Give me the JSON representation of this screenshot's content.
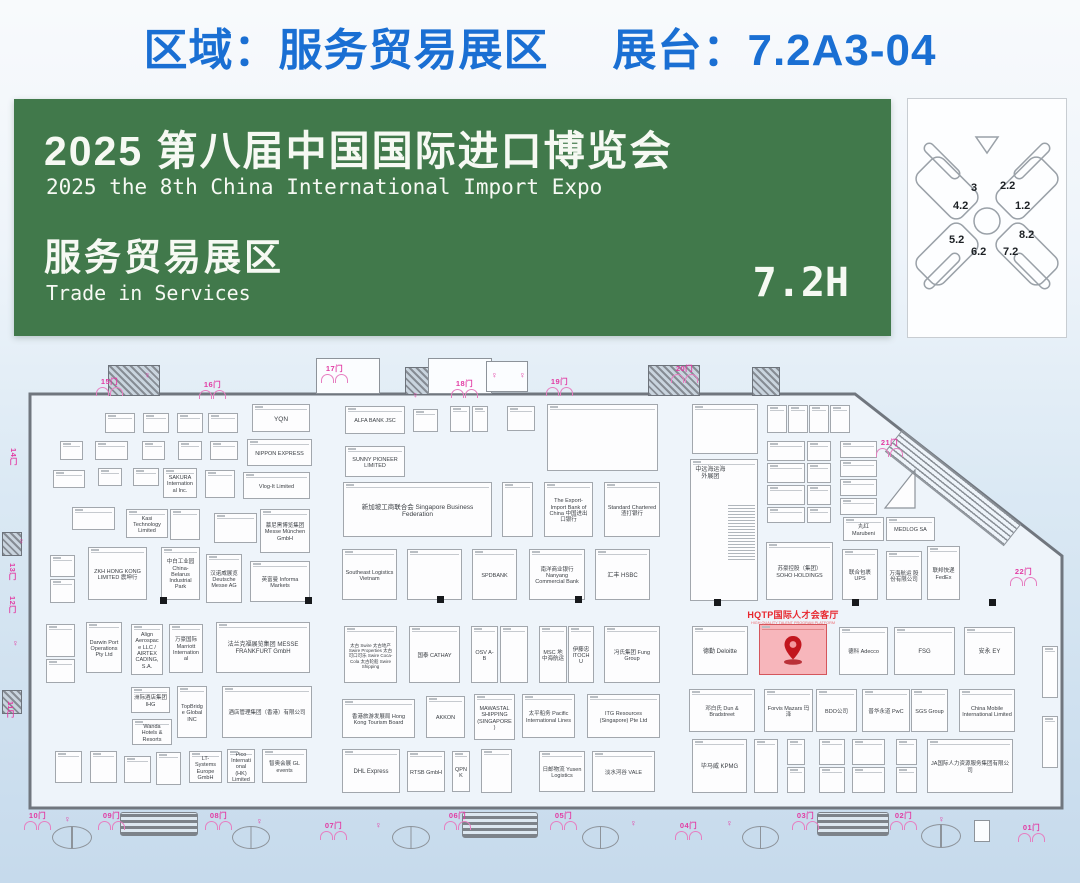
{
  "colors": {
    "accent": "#1a6fd3",
    "banner_bg": "#41794b",
    "magenta": "#e23ba3",
    "highlight_fill": "#f7b6bb",
    "pin_red": "#c2161e"
  },
  "header": {
    "zone_label": "区域：服务贸易展区",
    "booth_label": "展台：7.2A3-04"
  },
  "banner": {
    "zh_title": "2025 第八届中国国际进口博览会",
    "en_title": "2025 the 8th China International Import Expo",
    "zh_zone": "服务贸易展区",
    "en_zone": "Trade in Services",
    "hall_code": "7.2H"
  },
  "minimap": {
    "halls": [
      {
        "label": "3",
        "x": 63,
        "y": 83
      },
      {
        "label": "2.2",
        "x": 92,
        "y": 81
      },
      {
        "label": "4.2",
        "x": 45,
        "y": 101
      },
      {
        "label": "1.2",
        "x": 107,
        "y": 101
      },
      {
        "label": "5.2",
        "x": 41,
        "y": 135
      },
      {
        "label": "8.2",
        "x": 111,
        "y": 130
      },
      {
        "label": "6.2",
        "x": 63,
        "y": 147
      },
      {
        "label": "7.2",
        "x": 95,
        "y": 147
      }
    ]
  },
  "target": {
    "name": "HQTP国际人才会客厅",
    "subtitle": "HIGH QUALITY TALENT PROGRAM PLATFORM",
    "booth_no": "7.2A3-04"
  },
  "plan": {
    "gates": [
      [
        "15门",
        96,
        376,
        "h"
      ],
      [
        "16门",
        199,
        379,
        "h"
      ],
      [
        "17门",
        321,
        363,
        "h"
      ],
      [
        "18门",
        451,
        378,
        "h"
      ],
      [
        "19门",
        546,
        376,
        "h"
      ],
      [
        "20门",
        671,
        363,
        "h"
      ],
      [
        "21门",
        876,
        437,
        "h"
      ],
      [
        "22门",
        1010,
        566,
        "h"
      ],
      [
        "14门",
        8,
        448,
        "v"
      ],
      [
        "13门",
        7,
        563,
        "v"
      ],
      [
        "12门",
        7,
        596,
        "v"
      ],
      [
        "11门",
        5,
        701,
        "v"
      ],
      [
        "10门",
        24,
        810,
        "h"
      ],
      [
        "09门",
        98,
        810,
        "h"
      ],
      [
        "08门",
        205,
        810,
        "h"
      ],
      [
        "07门",
        320,
        820,
        "h"
      ],
      [
        "06门",
        444,
        810,
        "h"
      ],
      [
        "05门",
        550,
        810,
        "h"
      ],
      [
        "04门",
        675,
        820,
        "h"
      ],
      [
        "03门",
        792,
        810,
        "h"
      ],
      [
        "02门",
        890,
        810,
        "h"
      ],
      [
        "01门",
        1018,
        822,
        "h"
      ]
    ],
    "booths": [
      [
        105,
        413,
        30,
        20,
        ""
      ],
      [
        143,
        413,
        26,
        20,
        ""
      ],
      [
        177,
        413,
        26,
        20,
        ""
      ],
      [
        208,
        413,
        30,
        20,
        ""
      ],
      [
        60,
        441,
        23,
        19,
        ""
      ],
      [
        95,
        441,
        33,
        19,
        ""
      ],
      [
        142,
        441,
        23,
        19,
        ""
      ],
      [
        178,
        441,
        24,
        19,
        ""
      ],
      [
        210,
        441,
        28,
        19,
        ""
      ],
      [
        252,
        404,
        58,
        28,
        "YQN",
        6.5
      ],
      [
        247,
        439,
        65,
        27,
        "NIPPON EXPRESS",
        5.5
      ],
      [
        345,
        406,
        60,
        28,
        "ALFA BANK JSC"
      ],
      [
        345,
        446,
        60,
        31,
        "SUNNY PIONEER LIMITED"
      ],
      [
        413,
        409,
        25,
        23,
        ""
      ],
      [
        450,
        406,
        20,
        26,
        ""
      ],
      [
        472,
        406,
        16,
        26,
        ""
      ],
      [
        507,
        406,
        28,
        25,
        ""
      ],
      [
        547,
        404,
        111,
        67,
        ""
      ],
      [
        692,
        404,
        66,
        50,
        ""
      ],
      [
        767,
        405,
        20,
        28,
        ""
      ],
      [
        788,
        405,
        20,
        28,
        ""
      ],
      [
        809,
        405,
        20,
        28,
        ""
      ],
      [
        830,
        405,
        20,
        28,
        ""
      ],
      [
        767,
        441,
        38,
        20,
        ""
      ],
      [
        807,
        441,
        24,
        20,
        ""
      ],
      [
        767,
        463,
        38,
        20,
        ""
      ],
      [
        807,
        463,
        24,
        20,
        ""
      ],
      [
        767,
        485,
        38,
        20,
        ""
      ],
      [
        807,
        485,
        24,
        20,
        ""
      ],
      [
        767,
        507,
        38,
        16,
        ""
      ],
      [
        807,
        507,
        24,
        16,
        ""
      ],
      [
        840,
        441,
        37,
        17,
        ""
      ],
      [
        840,
        460,
        37,
        17,
        ""
      ],
      [
        840,
        479,
        37,
        17,
        ""
      ],
      [
        840,
        498,
        37,
        17,
        ""
      ],
      [
        53,
        470,
        32,
        18,
        ""
      ],
      [
        98,
        468,
        24,
        18,
        ""
      ],
      [
        133,
        468,
        26,
        18,
        ""
      ],
      [
        163,
        468,
        34,
        30,
        "SAKURA International Inc."
      ],
      [
        205,
        470,
        30,
        28,
        ""
      ],
      [
        243,
        472,
        67,
        27,
        "Vlog-It Limited"
      ],
      [
        72,
        507,
        43,
        23,
        ""
      ],
      [
        126,
        509,
        42,
        29,
        "Kasi Technology Limited"
      ],
      [
        170,
        509,
        30,
        31,
        ""
      ],
      [
        214,
        513,
        43,
        30,
        ""
      ],
      [
        260,
        509,
        50,
        44,
        "慕尼黑博览集团 Messe München GmbH"
      ],
      [
        343,
        482,
        149,
        55,
        "新加坡工商联合会 Singapore Business Federation",
        6.5
      ],
      [
        502,
        482,
        31,
        55,
        ""
      ],
      [
        544,
        482,
        49,
        55,
        "The Export-Import Bank of China 中国进出口银行"
      ],
      [
        604,
        482,
        56,
        55,
        "Standard Chartered 渣打银行"
      ],
      [
        690,
        459,
        68,
        142,
        "中远海运海外展团",
        6,
        "dense"
      ],
      [
        843,
        517,
        41,
        24,
        "丸红 Marubeni"
      ],
      [
        886,
        517,
        49,
        24,
        "MEDLOG SA"
      ],
      [
        50,
        555,
        25,
        22,
        ""
      ],
      [
        50,
        579,
        25,
        24,
        ""
      ],
      [
        88,
        547,
        59,
        53,
        "ZKH HONG KONG LIMITED 震坤行"
      ],
      [
        161,
        547,
        39,
        53,
        "中白工业园 China-Belarus Industrial Park"
      ],
      [
        206,
        554,
        36,
        49,
        "汉诺威展览 Deutsche Messe AG"
      ],
      [
        250,
        561,
        60,
        41,
        "英富曼 Informa Markets"
      ],
      [
        342,
        549,
        55,
        51,
        "Southeast Logistics Vietnam"
      ],
      [
        407,
        549,
        55,
        51,
        ""
      ],
      [
        472,
        549,
        45,
        51,
        "SPDBANK"
      ],
      [
        529,
        549,
        56,
        51,
        "南洋商业银行 Nanyang Commercial Bank"
      ],
      [
        595,
        549,
        55,
        51,
        "汇丰 HSBC",
        6
      ],
      [
        766,
        542,
        67,
        58,
        "苏豪控股（集团） SOHO HOLDINGS"
      ],
      [
        842,
        549,
        36,
        51,
        "联合包裹 UPS"
      ],
      [
        886,
        551,
        36,
        49,
        "万海航运 股份有限公司"
      ],
      [
        927,
        546,
        33,
        54,
        "联邦快递 FedEx"
      ],
      [
        46,
        624,
        29,
        33,
        ""
      ],
      [
        46,
        659,
        29,
        24,
        ""
      ],
      [
        86,
        622,
        36,
        51,
        "Darwin Port Operations Pty Ltd"
      ],
      [
        131,
        624,
        32,
        51,
        "Align Aerospace LLC / AIRTEX CADING,S.A."
      ],
      [
        169,
        624,
        34,
        49,
        "万豪国际 Marriott International"
      ],
      [
        216,
        622,
        94,
        51,
        "法兰克福展览集团 MESSE FRANKFURT GmbH",
        6
      ],
      [
        344,
        626,
        53,
        57,
        "太古 Swire 太古地产 Swire Properties 太古可口可乐 Swire Coca-Cola 太古轮船 Swire Shipping",
        4.5
      ],
      [
        409,
        626,
        51,
        57,
        "国泰 CATHAY"
      ],
      [
        471,
        626,
        27,
        57,
        "OSV A-B"
      ],
      [
        500,
        626,
        28,
        57,
        ""
      ],
      [
        539,
        626,
        28,
        57,
        "MSC 地中海航运"
      ],
      [
        568,
        626,
        26,
        57,
        "伊藤忠 ITOCHU"
      ],
      [
        604,
        626,
        56,
        57,
        "冯氏集团 Fung Group"
      ],
      [
        692,
        626,
        56,
        49,
        "德勤 Deloitte",
        6
      ],
      [
        759,
        624,
        68,
        51,
        "",
        5.5,
        "hl"
      ],
      [
        839,
        627,
        49,
        48,
        "德科 Adecco"
      ],
      [
        894,
        627,
        61,
        48,
        "FSG",
        6
      ],
      [
        964,
        627,
        51,
        48,
        "安永 EY",
        6
      ],
      [
        131,
        687,
        39,
        26,
        "洲际酒店集团 IHG"
      ],
      [
        177,
        686,
        30,
        52,
        "TopBridge Global INC"
      ],
      [
        132,
        719,
        40,
        26,
        "Wanda Hotels & Resorts"
      ],
      [
        222,
        686,
        90,
        52,
        "酒店管理集团（香港）有限公司"
      ],
      [
        342,
        699,
        73,
        39,
        "香港旅游发展局 Hong Kong Tourism Board"
      ],
      [
        426,
        696,
        39,
        42,
        "AKKON"
      ],
      [
        474,
        694,
        41,
        46,
        "MAWASTAL SHIPPING (SINGAPORE)"
      ],
      [
        522,
        694,
        53,
        44,
        "太平船务 Pacific International Lines"
      ],
      [
        587,
        694,
        73,
        44,
        "ITG Resources (Singapore) Pte Ltd"
      ],
      [
        689,
        689,
        66,
        43,
        "邓白氏 Dun & Bradstreet"
      ],
      [
        764,
        689,
        49,
        43,
        "Forvis Mazars 玛泽"
      ],
      [
        816,
        689,
        41,
        43,
        "BDO公司"
      ],
      [
        862,
        689,
        48,
        43,
        "普华永道 PwC"
      ],
      [
        911,
        689,
        37,
        43,
        "SGS Group"
      ],
      [
        959,
        689,
        56,
        43,
        "China Mobile International Limited"
      ],
      [
        55,
        751,
        27,
        32,
        ""
      ],
      [
        90,
        751,
        27,
        32,
        ""
      ],
      [
        124,
        756,
        27,
        27,
        ""
      ],
      [
        156,
        752,
        25,
        33,
        ""
      ],
      [
        189,
        751,
        33,
        32,
        "LT-Systems Europe GmbH"
      ],
      [
        227,
        749,
        28,
        34,
        "Pico International (HK) Limited"
      ],
      [
        262,
        749,
        45,
        34,
        "智奥会展 GL events"
      ],
      [
        342,
        749,
        58,
        44,
        "DHL Express",
        6
      ],
      [
        407,
        751,
        38,
        41,
        "RTSB GmbH"
      ],
      [
        452,
        751,
        18,
        41,
        "QPNK"
      ],
      [
        481,
        749,
        31,
        44,
        ""
      ],
      [
        539,
        751,
        46,
        41,
        "日邮物流 Yusen Logistics"
      ],
      [
        592,
        751,
        63,
        41,
        "淡水河谷 VALE"
      ],
      [
        692,
        739,
        55,
        54,
        "毕马威 KPMG",
        6
      ],
      [
        754,
        739,
        24,
        54,
        ""
      ],
      [
        787,
        739,
        18,
        26,
        ""
      ],
      [
        787,
        767,
        18,
        26,
        ""
      ],
      [
        819,
        739,
        26,
        26,
        ""
      ],
      [
        819,
        767,
        26,
        26,
        ""
      ],
      [
        852,
        739,
        33,
        26,
        ""
      ],
      [
        852,
        767,
        33,
        26,
        ""
      ],
      [
        896,
        739,
        21,
        26,
        ""
      ],
      [
        896,
        767,
        21,
        26,
        ""
      ],
      [
        927,
        739,
        86,
        54,
        "JA国际人力资源服务集团有限公司"
      ],
      [
        1042,
        646,
        16,
        52,
        "",
        4
      ],
      [
        1042,
        716,
        16,
        52,
        "",
        4
      ]
    ],
    "columns": [
      [
        160,
        597
      ],
      [
        305,
        597
      ],
      [
        437,
        596
      ],
      [
        575,
        596
      ],
      [
        714,
        599
      ],
      [
        852,
        599
      ],
      [
        989,
        599
      ]
    ],
    "facilities": {
      "stairs": [
        [
          120,
          812,
          76,
          22
        ],
        [
          462,
          812,
          74,
          24
        ],
        [
          817,
          812,
          70,
          22
        ]
      ],
      "wc": [
        [
          52,
          826,
          38,
          21
        ],
        [
          232,
          826,
          36,
          21
        ],
        [
          392,
          826,
          36,
          21
        ],
        [
          582,
          826,
          35,
          21
        ],
        [
          742,
          826,
          35,
          21
        ],
        [
          921,
          824,
          38,
          22
        ]
      ],
      "blocks": [
        [
          108,
          365,
          50,
          29
        ],
        [
          648,
          365,
          50,
          29
        ],
        [
          752,
          367,
          26,
          27
        ],
        [
          405,
          367,
          22,
          26
        ],
        [
          2,
          532,
          18,
          22
        ],
        [
          2,
          690,
          18,
          22
        ]
      ],
      "outlines": [
        [
          316,
          358,
          62,
          34
        ],
        [
          428,
          358,
          62,
          34
        ],
        [
          486,
          361,
          40,
          29
        ],
        [
          974,
          820,
          14,
          20
        ]
      ],
      "persons": [
        [
          18,
          536
        ],
        [
          12,
          638
        ],
        [
          64,
          814
        ],
        [
          256,
          816
        ],
        [
          375,
          820
        ],
        [
          630,
          818
        ],
        [
          726,
          818
        ],
        [
          938,
          814
        ],
        [
          144,
          370
        ],
        [
          491,
          370
        ],
        [
          519,
          370
        ],
        [
          412,
          390
        ]
      ]
    }
  }
}
